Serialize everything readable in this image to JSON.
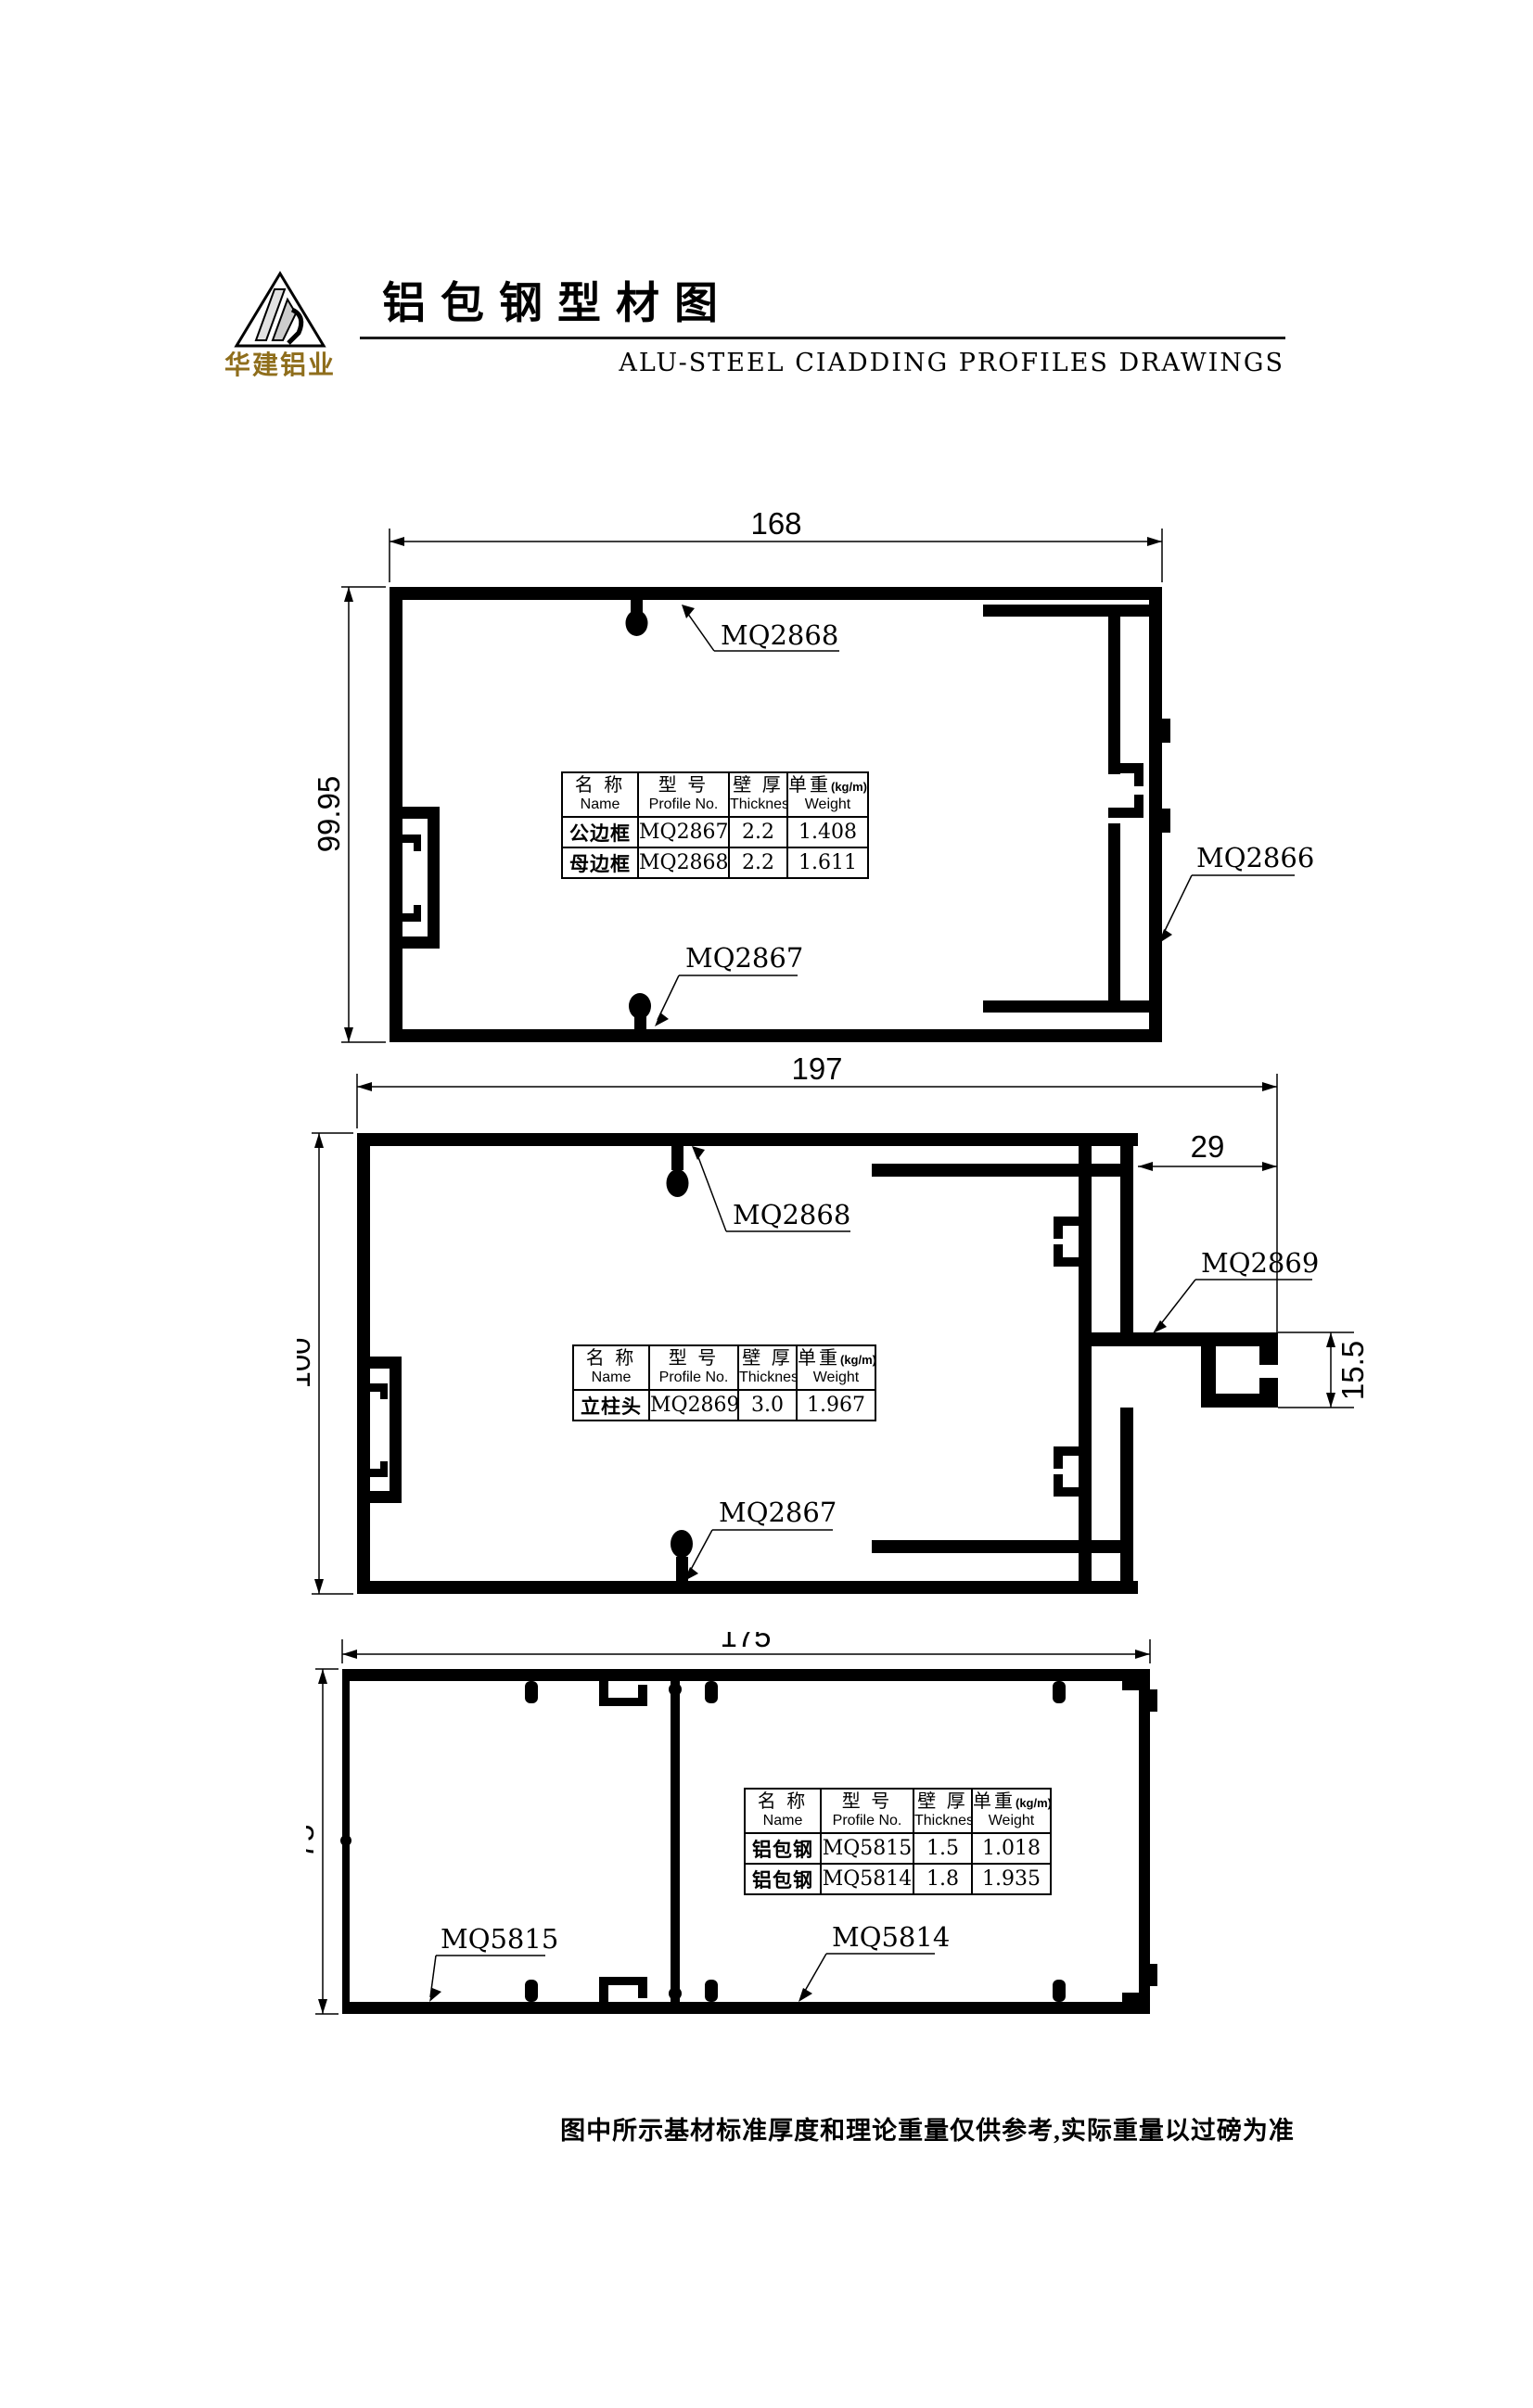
{
  "header": {
    "logo_text": "华建铝业",
    "title": "铝包钢型材图",
    "subtitle": "ALU-STEEL CIADDING PROFILES DRAWINGS"
  },
  "colors": {
    "line": "#000000",
    "brand_gold": "#8f6e1c"
  },
  "table_headers": [
    {
      "zh": "名 称",
      "en": "Name"
    },
    {
      "zh": "型 号",
      "en": "Profile No."
    },
    {
      "zh": "壁 厚",
      "en": "Thickness"
    },
    {
      "zh": "单重",
      "unit": "(kg/m)",
      "en": "Weight"
    }
  ],
  "drawings": {
    "d1": {
      "width_dim": "168",
      "height_dim": "99.95",
      "label_top": "MQ2868",
      "label_right": "MQ2866",
      "label_bottom": "MQ2867",
      "rows": [
        [
          "公边框",
          "MQ2867",
          "2.2",
          "1.408"
        ],
        [
          "母边框",
          "MQ2868",
          "2.2",
          "1.611"
        ]
      ]
    },
    "d2": {
      "width_dim": "197",
      "height_dim": "100",
      "arm_offset_dim": "29",
      "arm_height_dim": "15.5",
      "label_top": "MQ2868",
      "label_arm": "MQ2869",
      "label_bottom": "MQ2867",
      "rows": [
        [
          "立柱头",
          "MQ2869",
          "3.0",
          "1.967"
        ]
      ]
    },
    "d3": {
      "width_dim": "175",
      "height_dim": "75",
      "label_left": "MQ5815",
      "label_right": "MQ5814",
      "rows": [
        [
          "铝包钢",
          "MQ5815",
          "1.5",
          "1.018"
        ],
        [
          "铝包钢",
          "MQ5814",
          "1.8",
          "1.935"
        ]
      ]
    }
  },
  "footer": {
    "note": "图中所示基材标准厚度和理论重量仅供参考,实际重量以过磅为准"
  }
}
